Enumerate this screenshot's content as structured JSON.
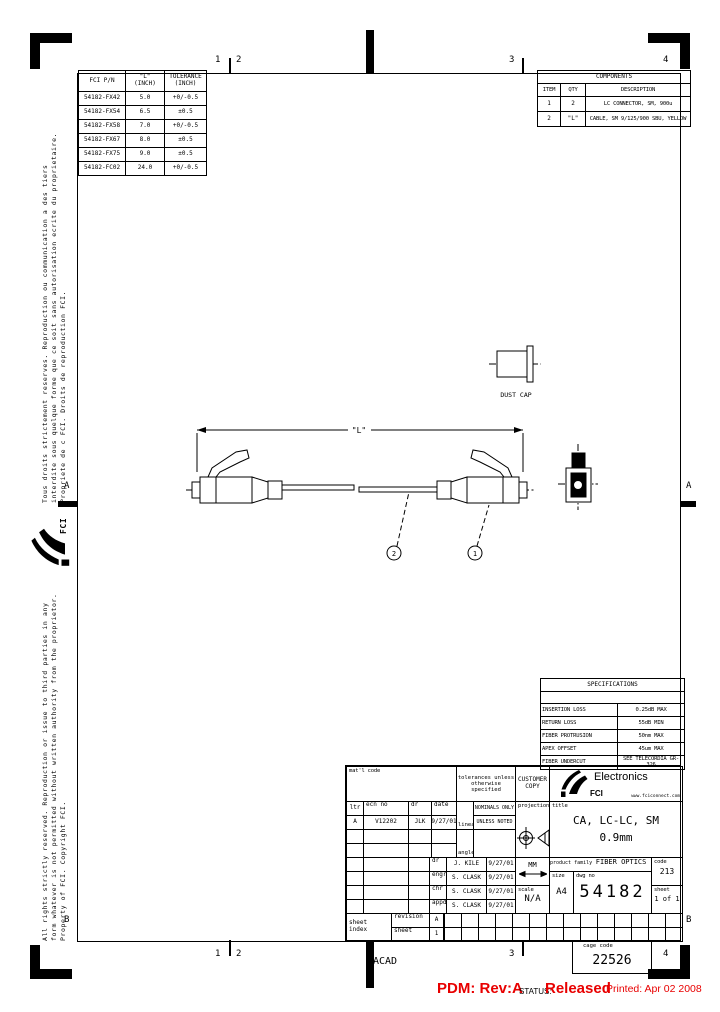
{
  "page": {
    "bg": "#ffffff",
    "ink": "#000000",
    "accent_red": "#e80000"
  },
  "zones": {
    "top": [
      "1",
      "2",
      "3",
      "4"
    ],
    "bottom": [
      "1",
      "2",
      "3",
      "4"
    ],
    "left": [
      "A",
      "B"
    ],
    "right": [
      "A",
      "B"
    ]
  },
  "pn_table": {
    "headers": [
      "FCI P/N",
      "\"L\"\n(INCH)",
      "TOLERANCE\n(INCH)"
    ],
    "rows": [
      [
        "54182-FX42",
        "5.0",
        "+0/-0.5"
      ],
      [
        "54182-FX54",
        "6.5",
        "±0.5"
      ],
      [
        "54182-FX58",
        "7.0",
        "+0/-0.5"
      ],
      [
        "54182-FX67",
        "8.0",
        "±0.5"
      ],
      [
        "54182-FX75",
        "9.0",
        "±0.5"
      ],
      [
        "54182-FC02",
        "24.0",
        "+0/-0.5"
      ]
    ]
  },
  "components_table": {
    "title": "COMPONENTS",
    "headers": [
      "ITEM",
      "QTY",
      "DESCRIPTION"
    ],
    "rows": [
      [
        "1",
        "2",
        "LC CONNECTOR, SM, 900u"
      ],
      [
        "2",
        "\"L\"",
        "CABLE, SM 9/125/900 SBU, YELLOW"
      ]
    ]
  },
  "spec_table": {
    "title": "SPECIFICATIONS",
    "rows": [
      [
        "INSERTION LOSS",
        "0.25dB MAX"
      ],
      [
        "RETURN LOSS",
        "55dB MIN"
      ],
      [
        "FIBER PROTRUSION",
        "50nm MAX"
      ],
      [
        "APEX OFFSET",
        "45um MAX"
      ],
      [
        "FIBER UNDERCUT",
        "SEE TELECORDIA GR-326"
      ]
    ]
  },
  "drawing": {
    "dim_label": "\"L\"",
    "dust_cap_label": "DUST CAP",
    "balloon_cable": "2",
    "balloon_connector": "1"
  },
  "title_block": {
    "matl_code_label": "mat'l code",
    "tolerances_note": "tolerances unless\notherwise specified",
    "customer_copy": "CUSTOMER\nCOPY",
    "brand": {
      "tagline": "Electronics",
      "name": "FCI",
      "site": "www.fciconnect.com"
    },
    "rev_headers": [
      "ltr",
      "ecn no",
      "dr",
      "date"
    ],
    "rev_row": [
      "A",
      "V12202",
      "JLK",
      "9/27/01"
    ],
    "linear_label": "linear",
    "nominals": "NOMINALS ONLY",
    "unless_noted": "UNLESS NOTED",
    "angles_label": "angles",
    "projection_label": "projection",
    "title_label": "title",
    "drawing_title": "CA, LC-LC, SM\n0.9mm",
    "approvals": [
      [
        "dr",
        "J. KILE",
        "9/27/01"
      ],
      [
        "engr",
        "S. CLASK",
        "9/27/01"
      ],
      [
        "chr",
        "S. CLASK",
        "9/27/01"
      ],
      [
        "appd",
        "S. CLASK",
        "9/27/01"
      ]
    ],
    "units": "MM",
    "scale_label": "scale",
    "scale_value": "N/A",
    "product_family_label": "product family",
    "product_family": "FIBER OPTICS",
    "code_label": "code",
    "code_value": "213",
    "size_label": "size",
    "size_value": "A4",
    "dwg_no_label": "dwg no",
    "dwg_no": "54182",
    "sheet_label": "sheet",
    "sheet_value": "1 of 1",
    "sheet_index_label": "sheet\nindex",
    "revision_label": "revision",
    "revision_value": "A",
    "sheet_row_label": "sheet",
    "sheet_row_value": "1"
  },
  "footer": {
    "acad": "ACAD",
    "cage_code_label": "cage code",
    "cage_code": "22526",
    "pdm": "PDM: Rev:A",
    "status_label": "STATUS:",
    "status_value": "Released",
    "printed": "Printed: Apr 02 2008"
  },
  "side_notes": {
    "french": [
      "Tous droits strictement reserves.  Reproduction ou communication a des tiers",
      "interdite sous quelque forme que ce soit sans autorisation ecrite du proprietaire.",
      "Propriete de c FCI.  Droits de reproduction FCI."
    ],
    "english": [
      "All rights strictly reserved.  Reproduction or issue to third parties in any",
      "form whatever is not permitted without written authority from the proprietor.",
      "Property of FCI.  Copyright FCI."
    ],
    "fci_vertical": "FCI"
  }
}
